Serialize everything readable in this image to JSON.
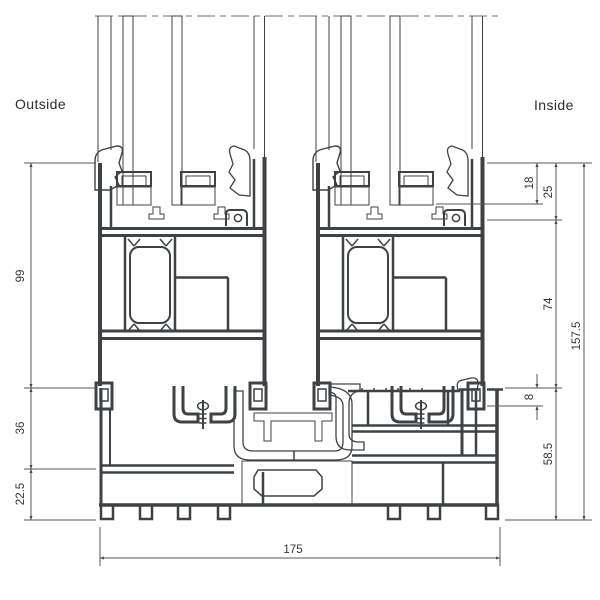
{
  "drawing": {
    "type": "technical-cross-section",
    "subject": "sliding window sill profile section"
  },
  "labels": {
    "outside": "Outside",
    "inside": "Inside"
  },
  "dimensions": {
    "left": [
      {
        "name": "sash-rail-height",
        "label": "99"
      },
      {
        "name": "track-zone-height",
        "label": "36"
      },
      {
        "name": "sill-chamber-height",
        "label": "22.5"
      }
    ],
    "right": [
      {
        "name": "glass-inset",
        "label": "18"
      },
      {
        "name": "glazing-rebate",
        "label": "25"
      },
      {
        "name": "rail-body-height",
        "label": "74"
      },
      {
        "name": "guide-lip-height",
        "label": "8"
      },
      {
        "name": "sill-height",
        "label": "58.5"
      },
      {
        "name": "total-height",
        "label": "157.5"
      }
    ],
    "bottom": [
      {
        "name": "total-depth",
        "label": "175"
      }
    ]
  },
  "colors": {
    "background": "#ffffff",
    "profile_line": "#3f4245",
    "light_gray_parts": "#cbcecb",
    "glass_fill": "#e8ecf1",
    "dimension_line": "#55585a",
    "text": "#34373a"
  }
}
